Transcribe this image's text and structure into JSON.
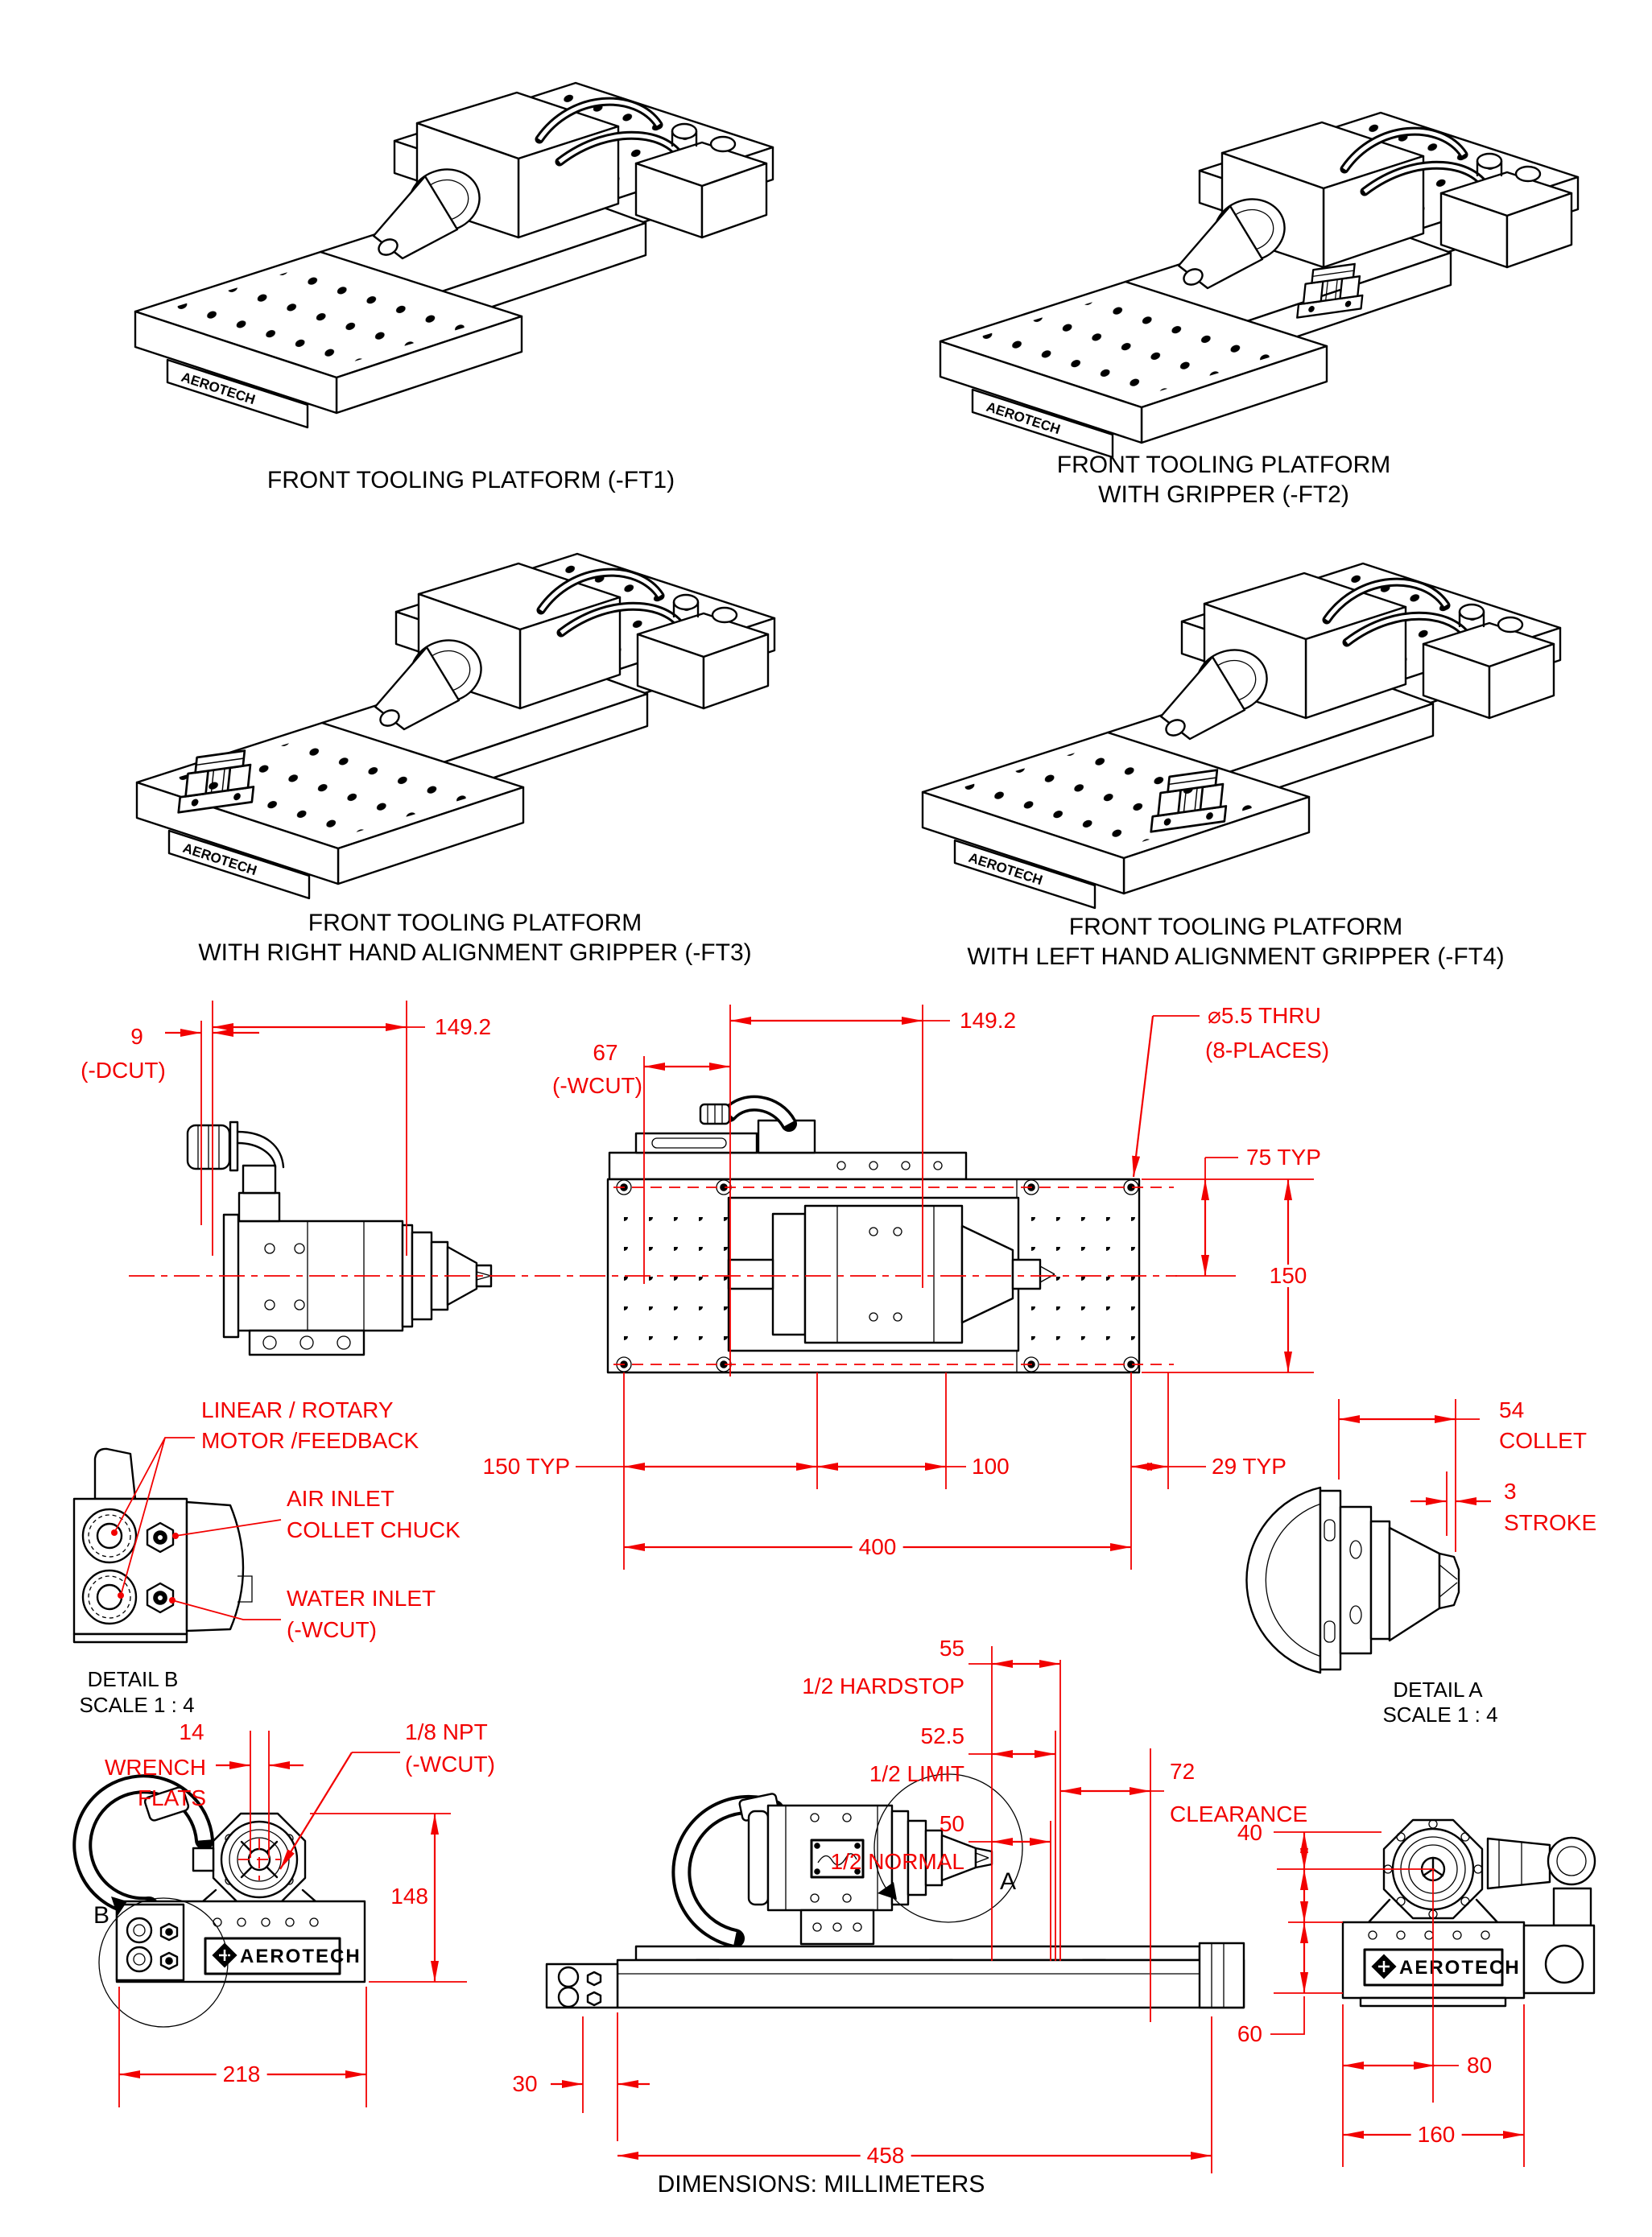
{
  "colors": {
    "annotation": "#f20000",
    "drawing": "#000000",
    "paper": "#ffffff"
  },
  "captions": {
    "ft1": "FRONT TOOLING PLATFORM (-FT1)",
    "ft2_line1": "FRONT TOOLING PLATFORM",
    "ft2_line2": "WITH GRIPPER (-FT2)",
    "ft3_line1": "FRONT TOOLING PLATFORM",
    "ft3_line2": "WITH RIGHT HAND ALIGNMENT GRIPPER (-FT3)",
    "ft4_line1": "FRONT TOOLING PLATFORM",
    "ft4_line2": "WITH LEFT HAND ALIGNMENT GRIPPER (-FT4)"
  },
  "side_view": {
    "d9": "9",
    "d9_note": "(-DCUT)",
    "d149": "149.2"
  },
  "plan_view": {
    "d67": "67",
    "d67_note": "(-WCUT)",
    "d149": "149.2",
    "hole_callout_1": "⌀5.5 THRU",
    "hole_callout_2": "(8-PLACES)",
    "d75": "75 TYP",
    "d150": "150",
    "d150typ": "150 TYP",
    "d100": "100",
    "d29": "29 TYP",
    "d400": "400"
  },
  "detail_b": {
    "title": "DETAIL B",
    "scale": "SCALE 1 : 4",
    "motor_label_1": "LINEAR / ROTARY",
    "motor_label_2": "MOTOR /FEEDBACK",
    "air_label_1": "AIR INLET",
    "air_label_2": "COLLET CHUCK",
    "water_label_1": "WATER INLET",
    "water_label_2": "(-WCUT)"
  },
  "detail_a": {
    "title": "DETAIL A",
    "scale": "SCALE 1 : 4",
    "d54": "54",
    "d54_label": "COLLET",
    "d3": "3",
    "d3_label": "STROKE"
  },
  "front_view": {
    "d14": "14",
    "wrench_1": "WRENCH",
    "wrench_2": "FLATS",
    "npt_1": "1/8 NPT",
    "npt_2": "(-WCUT)",
    "d148": "148",
    "d218": "218",
    "marker": "B"
  },
  "travel": {
    "d55": "55",
    "l55": "1/2 HARDSTOP",
    "d525": "52.5",
    "l525": "1/2 LIMIT",
    "d50": "50",
    "l50": "1/2 NORMAL",
    "d72": "72",
    "l72": "CLEARANCE",
    "d30": "30",
    "d458": "458",
    "marker": "A"
  },
  "end_view": {
    "d40": "40",
    "d60": "60",
    "d80": "80",
    "d160": "160"
  },
  "brand": {
    "logo": "AEROTECH"
  },
  "footer": "DIMENSIONS:  MILLIMETERS"
}
